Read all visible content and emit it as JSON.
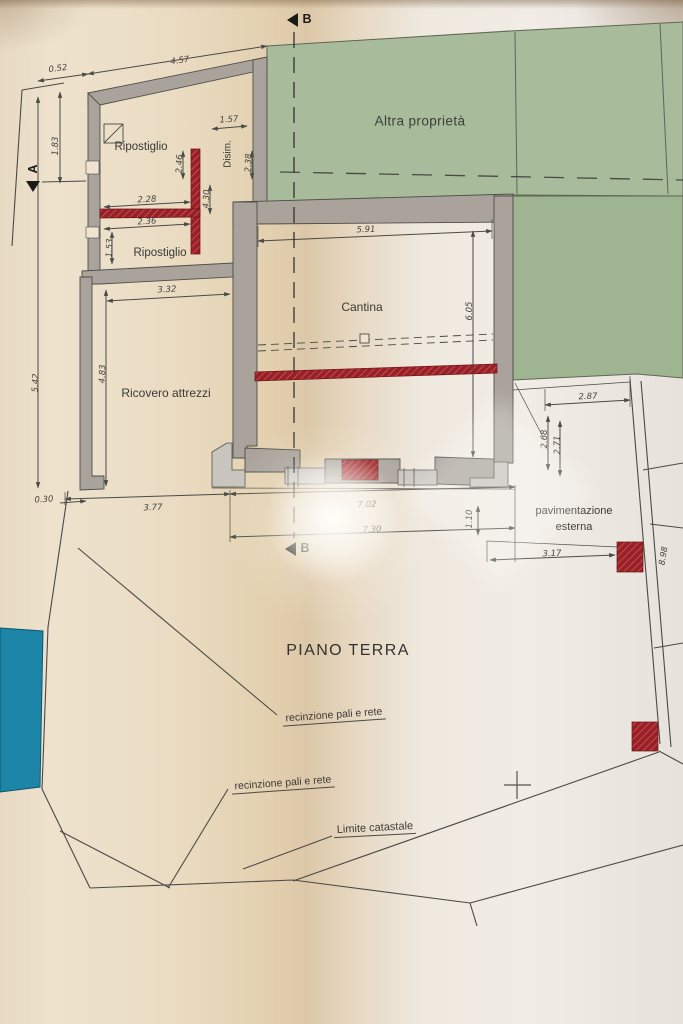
{
  "title": "PIANO TERRA",
  "areas": {
    "other_property": "Altra proprietà",
    "paving_line1": "pavimentazione",
    "paving_line2": "esterna"
  },
  "rooms": {
    "ripostiglio_top": "Ripostiglio",
    "disimpegno": "Disim.",
    "ripostiglio_lower": "Ripostiglio",
    "ricovero": "Ricovero attrezzi",
    "cantina": "Cantina"
  },
  "annotations": {
    "fence_1": "recinzione pali e rete",
    "fence_2": "recinzione pali e rete",
    "cadastral_limit": "Limite catastale"
  },
  "markers": {
    "section_a": "A",
    "section_b_top": "B",
    "section_b_bottom": "B"
  },
  "dims": [
    {
      "id": "d052",
      "text": "0.52"
    },
    {
      "id": "d457",
      "text": "4.57"
    },
    {
      "id": "d157",
      "text": "1.57"
    },
    {
      "id": "d228",
      "text": "2.28"
    },
    {
      "id": "d236",
      "text": "2.36"
    },
    {
      "id": "d332",
      "text": "3.32"
    },
    {
      "id": "d591",
      "text": "5.91"
    },
    {
      "id": "d287",
      "text": "2.87"
    },
    {
      "id": "d030",
      "text": "0.30"
    },
    {
      "id": "d377",
      "text": "3.77"
    },
    {
      "id": "d702",
      "text": "7.02"
    },
    {
      "id": "d730",
      "text": "7.30"
    },
    {
      "id": "d317",
      "text": "3.17"
    },
    {
      "id": "d183",
      "text": "1.83"
    },
    {
      "id": "d542",
      "text": "5.42"
    },
    {
      "id": "d483",
      "text": "4.83"
    },
    {
      "id": "d153",
      "text": "1.53"
    },
    {
      "id": "d246",
      "text": "2.46"
    },
    {
      "id": "d430",
      "text": "4.30"
    },
    {
      "id": "d238",
      "text": "2.38"
    },
    {
      "id": "d605",
      "text": "6.05"
    },
    {
      "id": "d268",
      "text": "2.68"
    },
    {
      "id": "d271",
      "text": "2.71"
    },
    {
      "id": "d110",
      "text": "1.10"
    },
    {
      "id": "d898",
      "text": "8.98"
    }
  ],
  "colors": {
    "green_area": "#a8bb9a",
    "wall_gray": "#a9a39b",
    "red_element": "#9b2026",
    "teal_element": "#1d86a8",
    "line": "#4a4a46"
  }
}
